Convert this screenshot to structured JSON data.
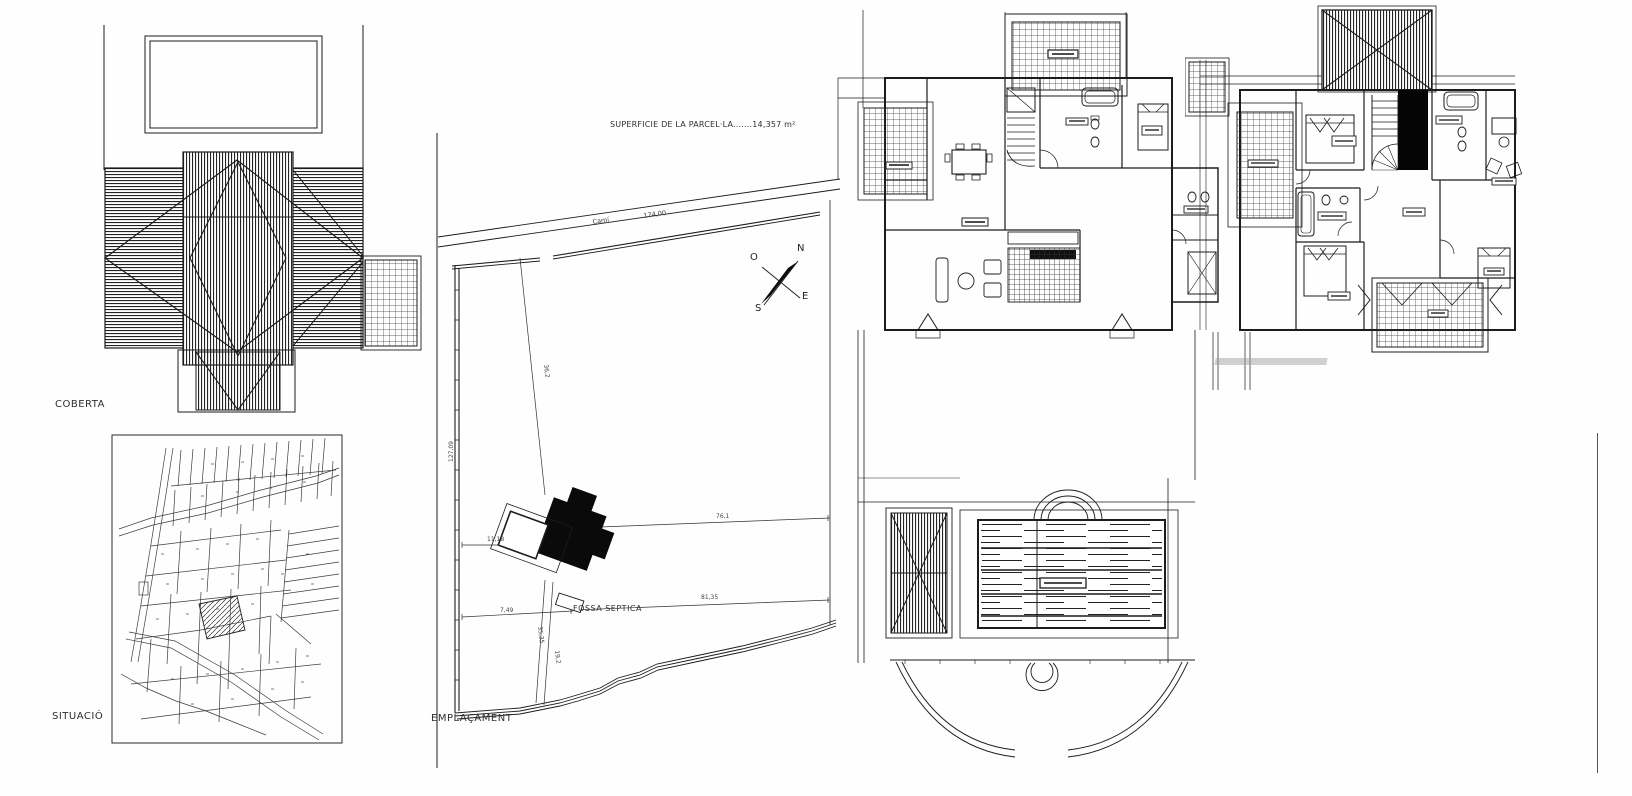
{
  "sheet": {
    "type": "architectural-plan-sheet",
    "background": "#fefefe",
    "line_color": "#1c1c1c"
  },
  "labels": {
    "roof_plan": "COBERTA",
    "situation_map": "SITUACIÓ",
    "site_plan": "EMPLAÇAMENT",
    "surface_note": "SUPERFICIE DE LA PARCEL·LA.......14,357 m²",
    "road_name": "Camí",
    "septic_tank": "FOSSA SEPTICA"
  },
  "compass": {
    "north": "N",
    "east": "E",
    "south": "S",
    "west": "O"
  },
  "dimensions": {
    "road_length": "174,00",
    "west_boundary": "127,09",
    "house_to_west": "11,18",
    "house_to_road": "36,2",
    "house_to_east": "76,1",
    "septic_to_east": "81,35",
    "septic_to_west": "7,49",
    "path_upper": "35,35",
    "path_lower": "19,2"
  }
}
